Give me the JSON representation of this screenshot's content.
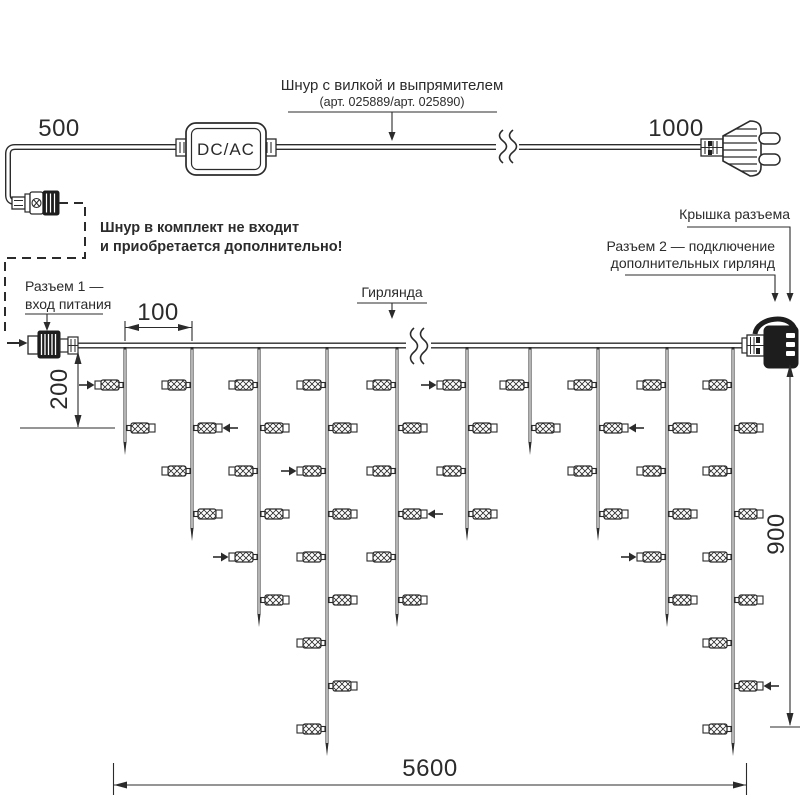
{
  "colors": {
    "line": "#2b2b2b",
    "background": "#ffffff",
    "cap_fill": "#1d1d1d"
  },
  "labels": {
    "cord_title": "Шнур с вилкой и выпрямителем",
    "cord_subtitle": "(арт. 025889/арт. 025890)",
    "cord_note_line1": "Шнур в комплект не входит",
    "cord_note_line2": "и приобретается дополнительно!",
    "connector1_line1": "Разъем 1 —",
    "connector1_line2": "вход питания",
    "connector2_line1": "Разъем 2 — подключение",
    "connector2_line2": "дополнительных гирлянд",
    "cap_label": "Крышка разъема",
    "garland_label": "Гирлянда",
    "converter_label": "DC/AC"
  },
  "dimensions": {
    "cord_left": "500",
    "cord_right": "1000",
    "drop_spacing": "100",
    "first_drop_height": "200",
    "garland_height": "900",
    "garland_width": "5600"
  },
  "garland": {
    "wire_y": 345.5,
    "led_row_start": 385,
    "led_row_spacing": 43,
    "break_x": 418,
    "drops": [
      {
        "x": 125,
        "leds": 2,
        "arrow_row": 1
      },
      {
        "x": 192,
        "leds": 4,
        "arrow_row": 2
      },
      {
        "x": 259,
        "leds": 6,
        "arrow_row": 5
      },
      {
        "x": 327,
        "leds": 9,
        "arrow_row": 3
      },
      {
        "x": 397,
        "leds": 6,
        "arrow_row": 4
      },
      {
        "x": 467,
        "leds": 4,
        "arrow_row": 1
      },
      {
        "x": 530,
        "leds": 2,
        "arrow_row": 0
      },
      {
        "x": 598,
        "leds": 4,
        "arrow_row": 2
      },
      {
        "x": 667,
        "leds": 6,
        "arrow_row": 5
      },
      {
        "x": 733,
        "leds": 9,
        "arrow_row": 8
      }
    ]
  }
}
